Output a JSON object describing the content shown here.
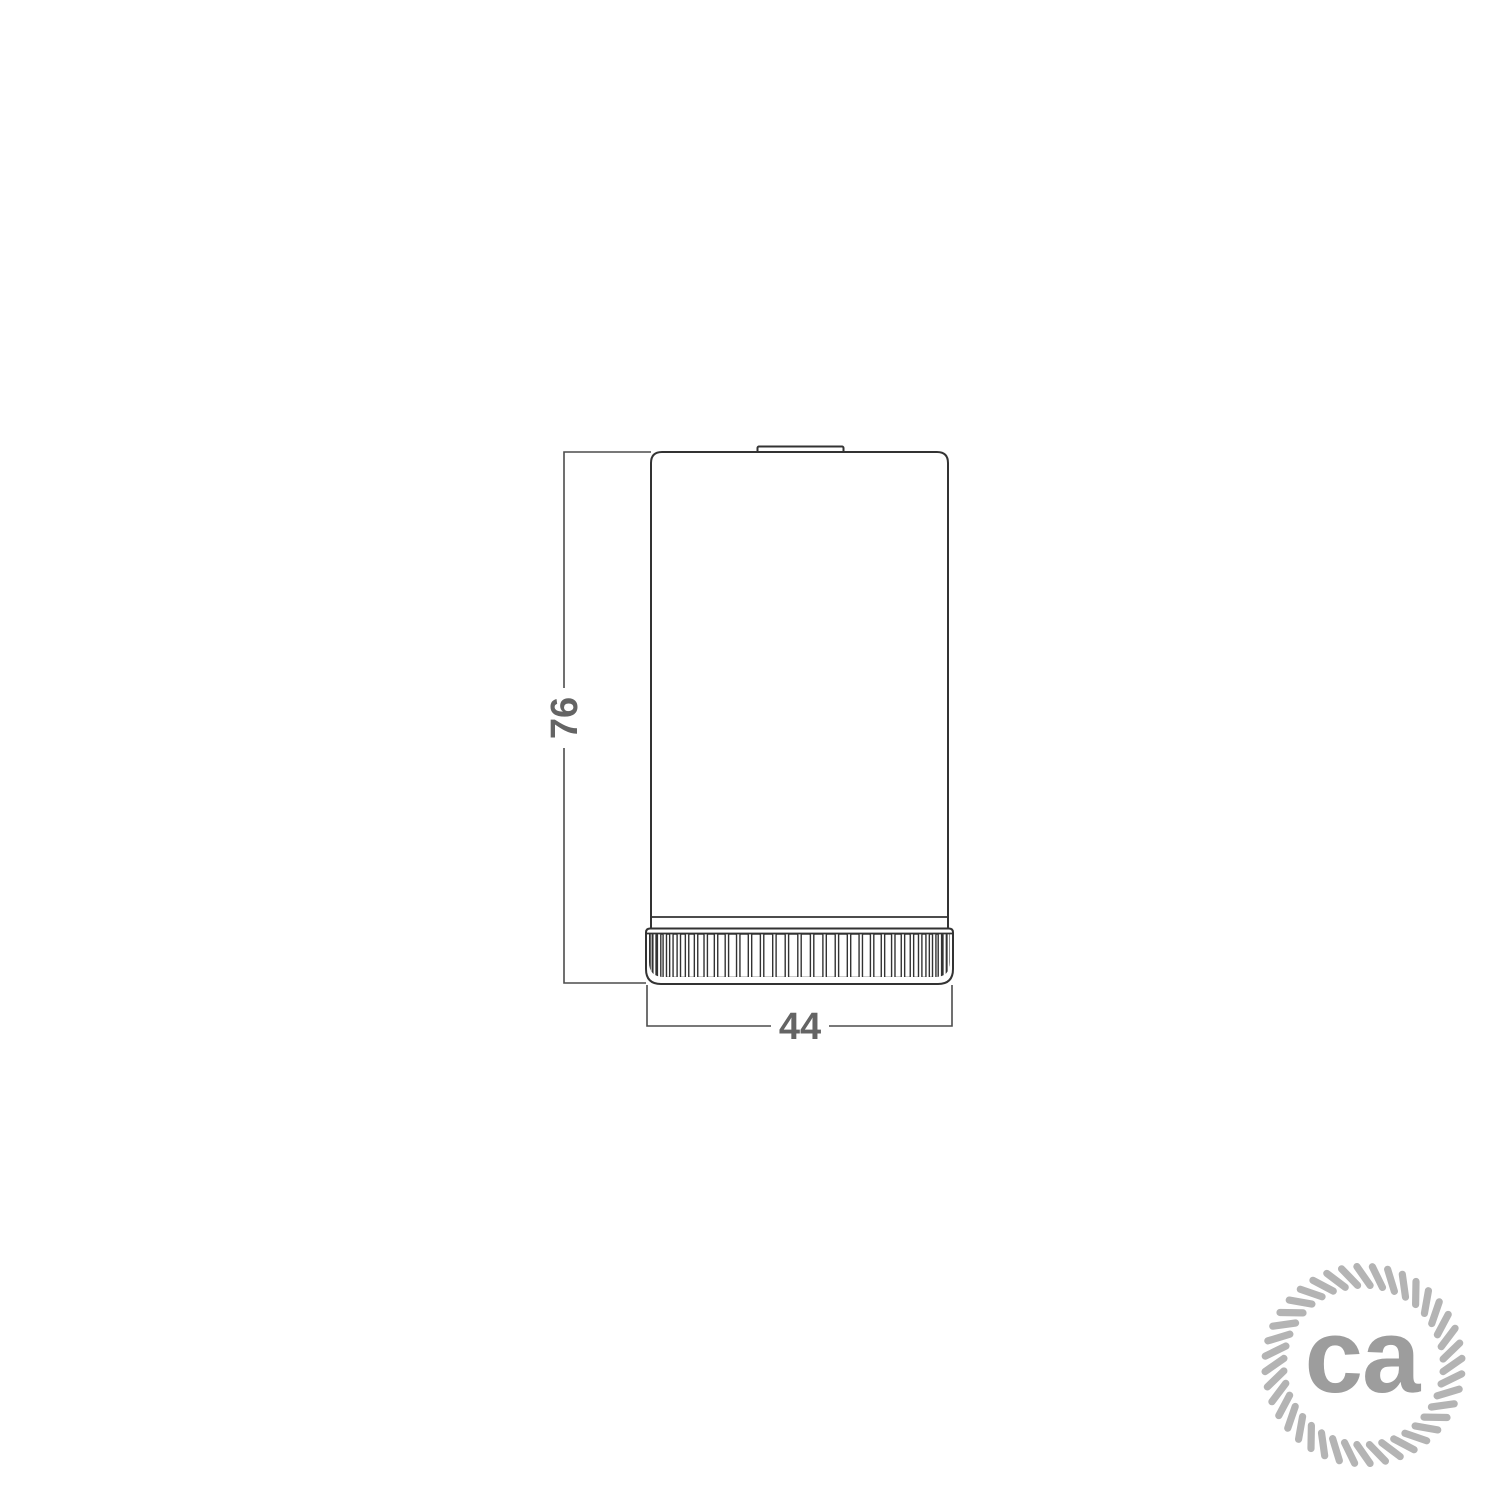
{
  "drawing": {
    "height_dimension_label": "76",
    "width_dimension_label": "44"
  },
  "logo": {
    "text": "ca"
  },
  "colors": {
    "background": "#ffffff",
    "object_line": "#333333",
    "dimension_line": "#4c4c4c",
    "dimension_text": "#646464",
    "logo_rope": "#b4b4b4",
    "logo_text": "#9d9d9d"
  }
}
